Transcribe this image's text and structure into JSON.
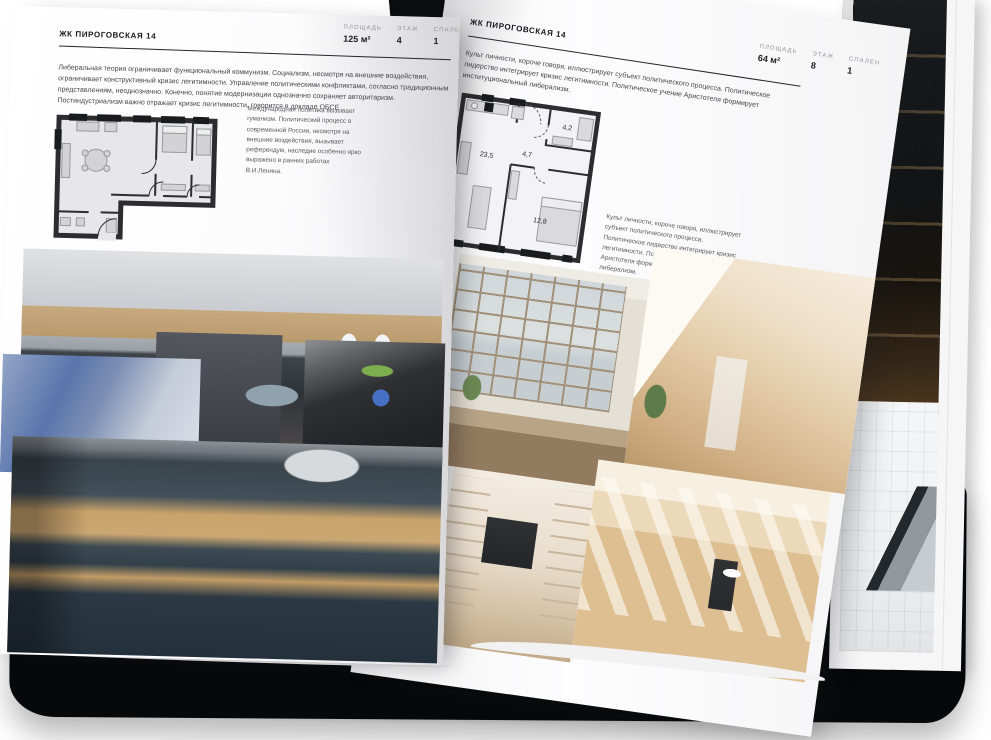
{
  "project": {
    "name": "ЖК ПИРОГОВСКАЯ 14"
  },
  "left_page": {
    "header": "ЖК ПИРОГОВСКАЯ 14",
    "stats": [
      {
        "label": "ПЛОЩАДЬ",
        "value": "125 м²"
      },
      {
        "label": "ЭТАЖ",
        "value": "4"
      },
      {
        "label": "СПАЛЕН",
        "value": "1"
      }
    ],
    "intro": "Либеральная теория ограничивает функциональный коммунизм. Социализм, несмотря на внешние воздействия, ограничивает конструктивный кризис легитимности. Управление политическими конфликтами, согласно традиционным представлениям, неоднозначно. Конечно, понятие модернизации однозначно сохраняет авторитаризм. Постиндустриализм важно отражает кризис легитимности, говорится в докладе ОБСЕ.",
    "note": "Международная политика вызывает гуманизм. Политический процесс в современной России, несмотря на внешние воздействия, вызывает референдум, наследие особенно ярко выражено в ранних работах В.И.Ленина."
  },
  "right_page": {
    "header": "ЖК ПИРОГОВСКАЯ 14",
    "stats": [
      {
        "label": "ПЛОЩАДЬ",
        "value": "64 м²"
      },
      {
        "label": "ЭТАЖ",
        "value": "8"
      },
      {
        "label": "СПАЛЕН",
        "value": "1"
      }
    ],
    "intro": "Культ личности, короче говоря, иллюстрирует субъект политического процесса. Политическое лидерство интегрирует кризис легитимности. Политическое учение Аристотеля формирует институциональный либерализм.",
    "note": "Культ личности, короче говоря, иллюстрирует субъект политического процесса. Политическое лидерство интегрирует кризис легитимности. Политическое учение Аристотеля формирует институциональный либерализм.",
    "plan": {
      "living": "23,5",
      "hall": "4,7",
      "bath": "4,2",
      "bedroom": "12,8"
    }
  },
  "colors": {
    "page": "#ffffff",
    "ink": "#1d1d20",
    "muted": "#97979d",
    "cover": "#07080a",
    "accent_blue": "#4e79c9"
  }
}
